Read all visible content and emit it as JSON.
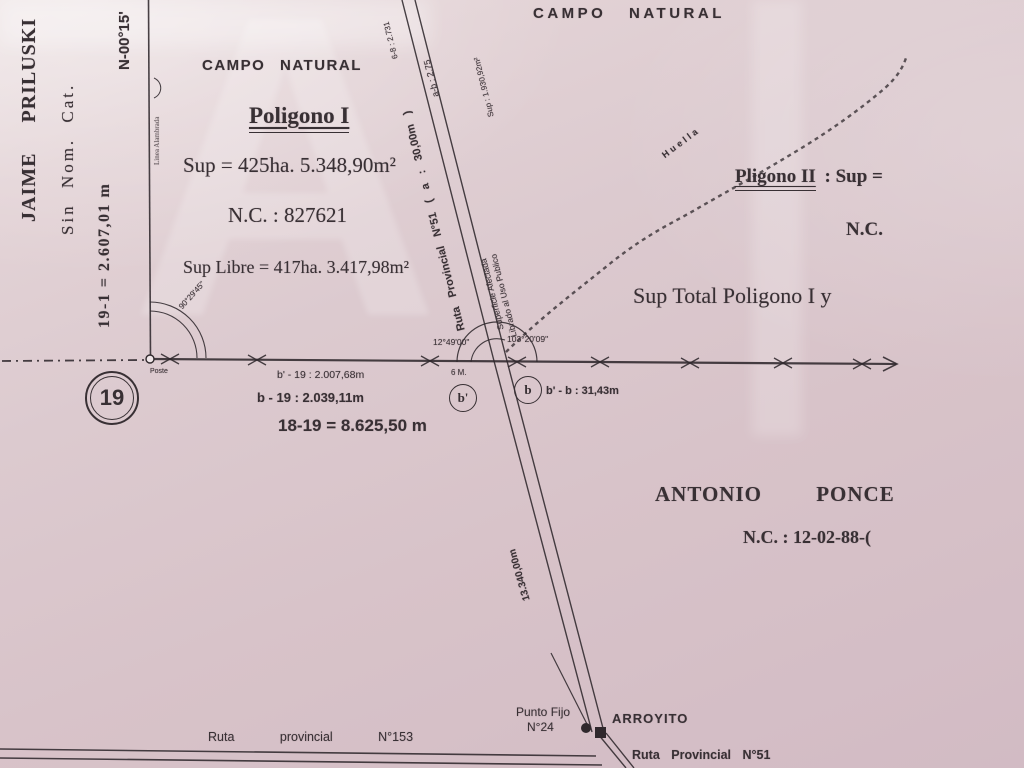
{
  "watermark": "A",
  "left_margin": {
    "owner": "JAIME PRILUSKI",
    "no_cadastre": "Sin Nom. Cat.",
    "side_19_1": "19-1 = 2.607,01 m",
    "bearing": "N-00°15'",
    "fence_line": "Linea Alambrada"
  },
  "campo_natural_left": "CAMPO NATURAL",
  "campo_natural_top": "CAMPO NATURAL",
  "poligono_1": {
    "title": "Poligono I",
    "sup": "Sup = 425ha. 5.348,90m²",
    "nc": "N.C. : 827621",
    "sup_libre": "Sup Libre = 417ha. 3.417,98m²"
  },
  "ruta_51": {
    "label": "Ruta Provincial N°51 ( a : 30,00m )",
    "sup_afectada": "Sup : 1.930,92m²",
    "superficie": "Superficie Afectada",
    "librado": "Librado al Uso Publico",
    "tiny_left": "6-8 : 2.731",
    "tiny_right": "a-b : 2.75"
  },
  "huella": "Huella",
  "poligono_2": {
    "title": "Pligono II",
    "sup": ": Sup =",
    "nc": "N.C.",
    "sup_total": "Sup Total Poligono I y"
  },
  "junction": {
    "angle_left": "12°49'00\"",
    "angle_right": "103°20'09\"",
    "six_m": "6 M.",
    "point_b_prime": "b'",
    "point_b": "b",
    "dist_bprime_b": "b' - b : 31,43m"
  },
  "baseline": {
    "dist_bprime_19": "b' - 19 : 2.007,68m",
    "dist_b_19": "b - 19 : 2.039,11m",
    "dist_18_19": "18-19 = 8.625,50 m"
  },
  "vertex_19": {
    "number": "19",
    "poste": "Poste",
    "angle": "90°29'45\""
  },
  "ponce": {
    "owner": "ANTONIO PONCE",
    "nc": "N.C. : 12-02-88-("
  },
  "ruta_51_lower": {
    "length": "13.340,00m"
  },
  "bottom": {
    "punto_fijo_line1": "Punto Fijo",
    "punto_fijo_line2": "N°24",
    "arroyito": "ARROYITO",
    "ruta_153": "Ruta provincial N°153",
    "ruta_51": "Ruta Provincial N°51"
  },
  "colors": {
    "paper": "#d9c5cb",
    "ink": "#383034"
  }
}
